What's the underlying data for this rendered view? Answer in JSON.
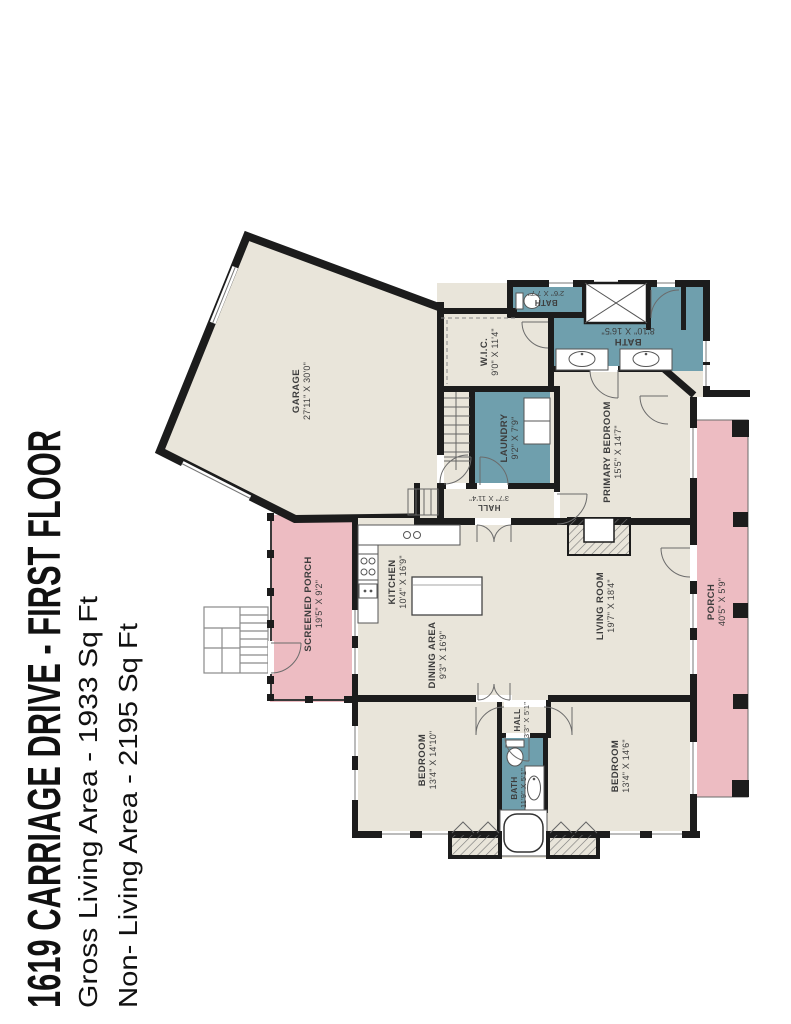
{
  "title": {
    "line1": "1619 CARRIAGE DRIVE - FIRST FLOOR",
    "line2": "Gross Living Area - 1933 Sq Ft",
    "line3": "Non- Living Area - 2195 Sq Ft"
  },
  "colors": {
    "room_fill": "#e9e5da",
    "wet_room_fill": "#6f9fad",
    "porch_fill": "#edbcc2",
    "wall": "#1c1c1c",
    "label_text": "#3d3d3d",
    "title_text": "#111111"
  },
  "rooms": {
    "garage": {
      "name": "GARAGE",
      "dims": "27'11\" X 30'0\""
    },
    "wic": {
      "name": "W.I.C.",
      "dims": "9'0\" X 11'4\""
    },
    "bath_small": {
      "name": "BATH",
      "dims": "2'6\" X 7'7\""
    },
    "bath_primary": {
      "name": "BATH",
      "dims": "8'10\" X 16'5\""
    },
    "laundry": {
      "name": "LAUNDRY",
      "dims": "9'2\" X 7'9\""
    },
    "hall_upper": {
      "name": "HALL",
      "dims": "3'7\" X 11'4\""
    },
    "primary_bedroom": {
      "name": "PRIMARY BEDROOM",
      "dims": "15'5\" X 14'7\""
    },
    "kitchen": {
      "name": "KITCHEN",
      "dims": "10'4\" X 16'9\""
    },
    "dining": {
      "name": "DINING AREA",
      "dims": "9'3\" X 16'9\""
    },
    "living": {
      "name": "LIVING ROOM",
      "dims": "19'7\" X 18'4\""
    },
    "screened_porch": {
      "name": "SCREENED PORCH",
      "dims": "19'5\" X 9'2\""
    },
    "porch": {
      "name": "PORCH",
      "dims": "40'5\" X 5'9\""
    },
    "bedroom_left": {
      "name": "BEDROOM",
      "dims": "13'4\" X 14'10\""
    },
    "hall_lower": {
      "name": "HALL",
      "dims": "3'3\" X 5'1\""
    },
    "bath_hall": {
      "name": "BATH",
      "dims": "11'9\" X 5'1\""
    },
    "bedroom_right": {
      "name": "BEDROOM",
      "dims": "13'4\" X 14'6\""
    }
  }
}
